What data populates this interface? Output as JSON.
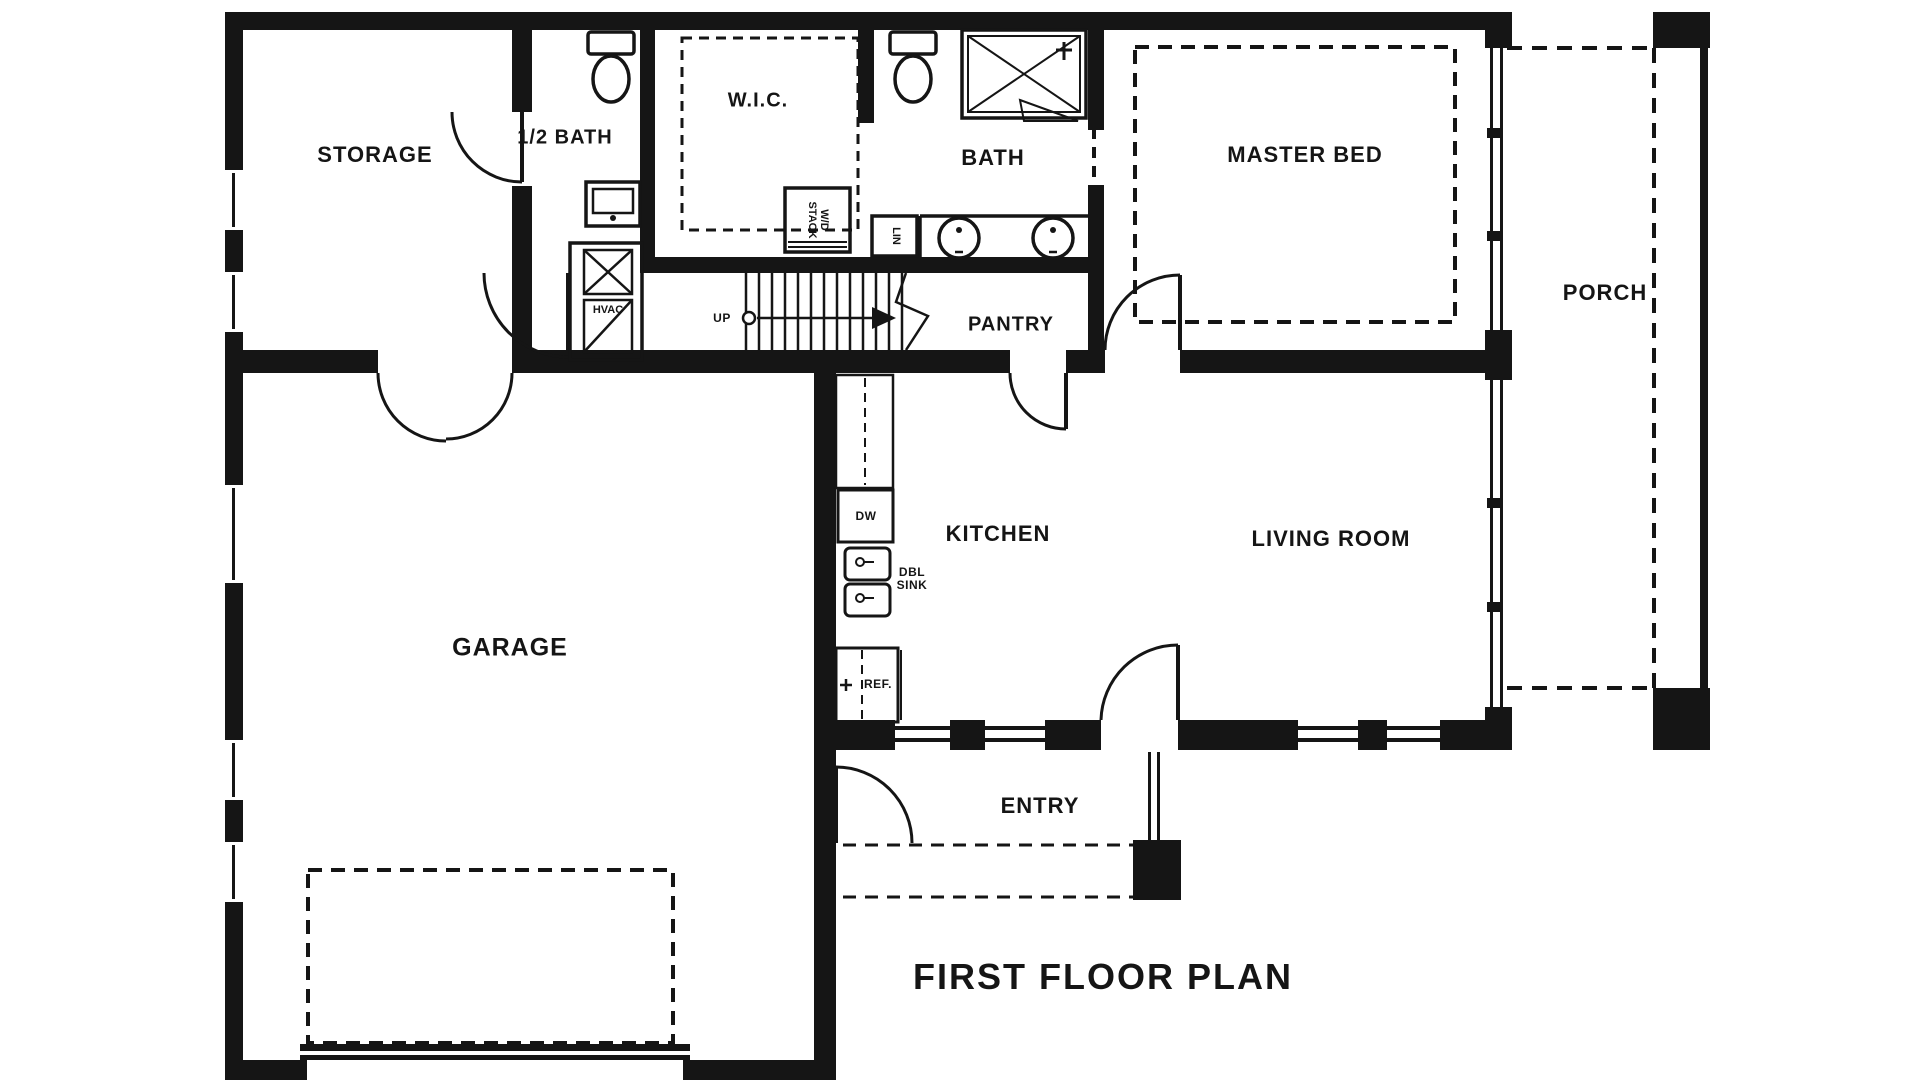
{
  "title": "FIRST FLOOR PLAN",
  "colors": {
    "ink": "#151515",
    "bg": "#ffffff"
  },
  "rooms": {
    "storage": "STORAGE",
    "half_bath": "1/2 BATH",
    "wic": "W.I.C.",
    "bath": "BATH",
    "master_bed": "MASTER BED",
    "porch": "PORCH",
    "pantry": "PANTRY",
    "kitchen": "KITCHEN",
    "living_room": "LIVING ROOM",
    "garage": "GARAGE",
    "entry": "ENTRY"
  },
  "annotations": {
    "stairs_up": "UP",
    "washer_dryer_line1": "W/D",
    "washer_dryer_line2": "STACK",
    "linen": "LIN",
    "hvac": "HVAC",
    "dishwasher": "DW",
    "dbl_sink_line1": "DBL",
    "dbl_sink_line2": "SINK",
    "refrigerator": "REF."
  }
}
